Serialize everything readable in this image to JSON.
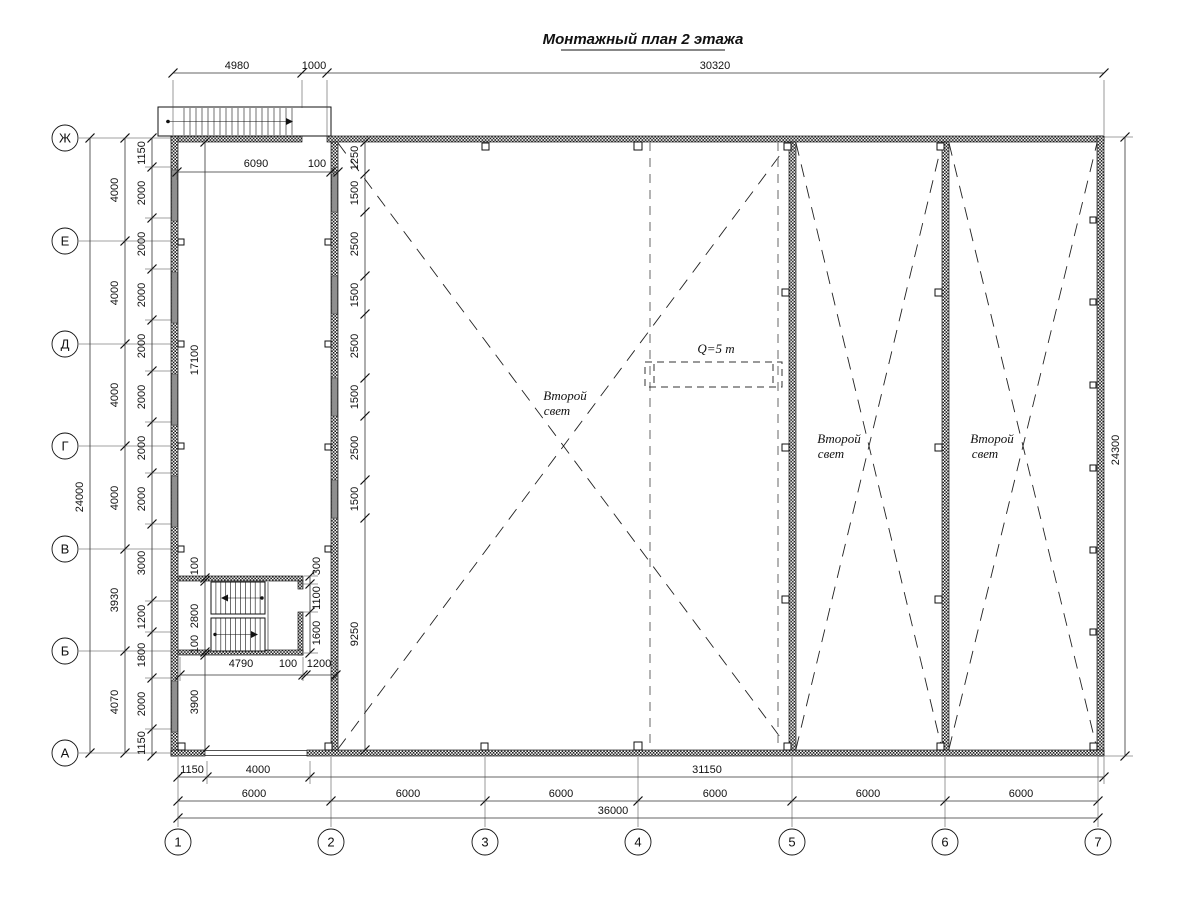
{
  "title": {
    "text": "Монтажный план 2 этажа"
  },
  "colors": {
    "line": "#1a1a1a",
    "window_gray": "#8f8f8f",
    "crane_dash": "#8a8a8a",
    "paper": "#ffffff"
  },
  "axes": {
    "rows": [
      {
        "label": "Ж",
        "y": 138
      },
      {
        "label": "Е",
        "y": 241
      },
      {
        "label": "Д",
        "y": 344
      },
      {
        "label": "Г",
        "y": 446
      },
      {
        "label": "В",
        "y": 549
      },
      {
        "label": "Б",
        "y": 651
      },
      {
        "label": "А",
        "y": 753
      }
    ],
    "cols": [
      {
        "label": "1",
        "x": 178
      },
      {
        "label": "2",
        "x": 331
      },
      {
        "label": "3",
        "x": 485
      },
      {
        "label": "4",
        "x": 638
      },
      {
        "label": "5",
        "x": 792
      },
      {
        "label": "6",
        "x": 945
      },
      {
        "label": "7",
        "x": 1098
      }
    ]
  },
  "dimensions": [
    {
      "text": "4980",
      "x": 237,
      "y": 69,
      "rot": 0
    },
    {
      "text": "1000",
      "x": 314,
      "y": 69,
      "rot": 0
    },
    {
      "text": "30320",
      "x": 715,
      "y": 69,
      "rot": 0
    },
    {
      "text": "6090",
      "x": 256,
      "y": 167,
      "rot": 0
    },
    {
      "text": "100",
      "x": 317,
      "y": 167,
      "rot": 0
    },
    {
      "text": "24000",
      "x": 83,
      "y": 497,
      "rot": 1
    },
    {
      "text": "4000",
      "x": 118,
      "y": 190,
      "rot": 1
    },
    {
      "text": "4000",
      "x": 118,
      "y": 293,
      "rot": 1
    },
    {
      "text": "4000",
      "x": 118,
      "y": 395,
      "rot": 1
    },
    {
      "text": "4000",
      "x": 118,
      "y": 498,
      "rot": 1
    },
    {
      "text": "3930",
      "x": 118,
      "y": 600,
      "rot": 1
    },
    {
      "text": "4070",
      "x": 118,
      "y": 702,
      "rot": 1
    },
    {
      "text": "1150",
      "x": 145,
      "y": 153,
      "rot": 1
    },
    {
      "text": "2000",
      "x": 145,
      "y": 193,
      "rot": 1
    },
    {
      "text": "2000",
      "x": 145,
      "y": 244,
      "rot": 1
    },
    {
      "text": "2000",
      "x": 145,
      "y": 295,
      "rot": 1
    },
    {
      "text": "2000",
      "x": 145,
      "y": 346,
      "rot": 1
    },
    {
      "text": "2000",
      "x": 145,
      "y": 397,
      "rot": 1
    },
    {
      "text": "2000",
      "x": 145,
      "y": 448,
      "rot": 1
    },
    {
      "text": "2000",
      "x": 145,
      "y": 499,
      "rot": 1
    },
    {
      "text": "3000",
      "x": 145,
      "y": 563,
      "rot": 1
    },
    {
      "text": "1200",
      "x": 145,
      "y": 617,
      "rot": 1
    },
    {
      "text": "1800",
      "x": 145,
      "y": 655,
      "rot": 1
    },
    {
      "text": "2000",
      "x": 145,
      "y": 704,
      "rot": 1
    },
    {
      "text": "1150",
      "x": 145,
      "y": 743,
      "rot": 1
    },
    {
      "text": "17100",
      "x": 198,
      "y": 360,
      "rot": 1
    },
    {
      "text": "100",
      "x": 198,
      "y": 566,
      "rot": 1
    },
    {
      "text": "2800",
      "x": 198,
      "y": 616,
      "rot": 1
    },
    {
      "text": "100",
      "x": 198,
      "y": 644,
      "rot": 1
    },
    {
      "text": "3900",
      "x": 198,
      "y": 702,
      "rot": 1
    },
    {
      "text": "1250",
      "x": 358,
      "y": 158,
      "rot": 1
    },
    {
      "text": "1500",
      "x": 358,
      "y": 193,
      "rot": 1
    },
    {
      "text": "2500",
      "x": 358,
      "y": 244,
      "rot": 1
    },
    {
      "text": "1500",
      "x": 358,
      "y": 295,
      "rot": 1
    },
    {
      "text": "2500",
      "x": 358,
      "y": 346,
      "rot": 1
    },
    {
      "text": "1500",
      "x": 358,
      "y": 397,
      "rot": 1
    },
    {
      "text": "2500",
      "x": 358,
      "y": 448,
      "rot": 1
    },
    {
      "text": "1500",
      "x": 358,
      "y": 499,
      "rot": 1
    },
    {
      "text": "9250",
      "x": 358,
      "y": 634,
      "rot": 1
    },
    {
      "text": "300",
      "x": 320,
      "y": 566,
      "rot": 1
    },
    {
      "text": "1100",
      "x": 320,
      "y": 598,
      "rot": 1
    },
    {
      "text": "1600",
      "x": 320,
      "y": 633,
      "rot": 1
    },
    {
      "text": "4790",
      "x": 241,
      "y": 667,
      "rot": 0
    },
    {
      "text": "100",
      "x": 288,
      "y": 667,
      "rot": 0
    },
    {
      "text": "1200",
      "x": 319,
      "y": 667,
      "rot": 0
    },
    {
      "text": "1150",
      "x": 192,
      "y": 773,
      "rot": 0
    },
    {
      "text": "4000",
      "x": 258,
      "y": 773,
      "rot": 0
    },
    {
      "text": "31150",
      "x": 707,
      "y": 773,
      "rot": 0
    },
    {
      "text": "6000",
      "x": 254,
      "y": 797,
      "rot": 0
    },
    {
      "text": "6000",
      "x": 408,
      "y": 797,
      "rot": 0
    },
    {
      "text": "6000",
      "x": 561,
      "y": 797,
      "rot": 0
    },
    {
      "text": "6000",
      "x": 715,
      "y": 797,
      "rot": 0
    },
    {
      "text": "6000",
      "x": 868,
      "y": 797,
      "rot": 0
    },
    {
      "text": "6000",
      "x": 1021,
      "y": 797,
      "rot": 0
    },
    {
      "text": "36000",
      "x": 613,
      "y": 814,
      "rot": 0
    },
    {
      "text": "24300",
      "x": 1119,
      "y": 450,
      "rot": 1
    }
  ],
  "annotations": [
    {
      "text": "Второй",
      "x": 565,
      "y": 400
    },
    {
      "text": "свет",
      "x": 557,
      "y": 415
    },
    {
      "text": "Второй",
      "x": 839,
      "y": 443
    },
    {
      "text": "свет",
      "x": 831,
      "y": 458
    },
    {
      "text": "Второй",
      "x": 992,
      "y": 443
    },
    {
      "text": "свет",
      "x": 985,
      "y": 458
    },
    {
      "text": "Q=5 т",
      "x": 716,
      "y": 353
    }
  ]
}
